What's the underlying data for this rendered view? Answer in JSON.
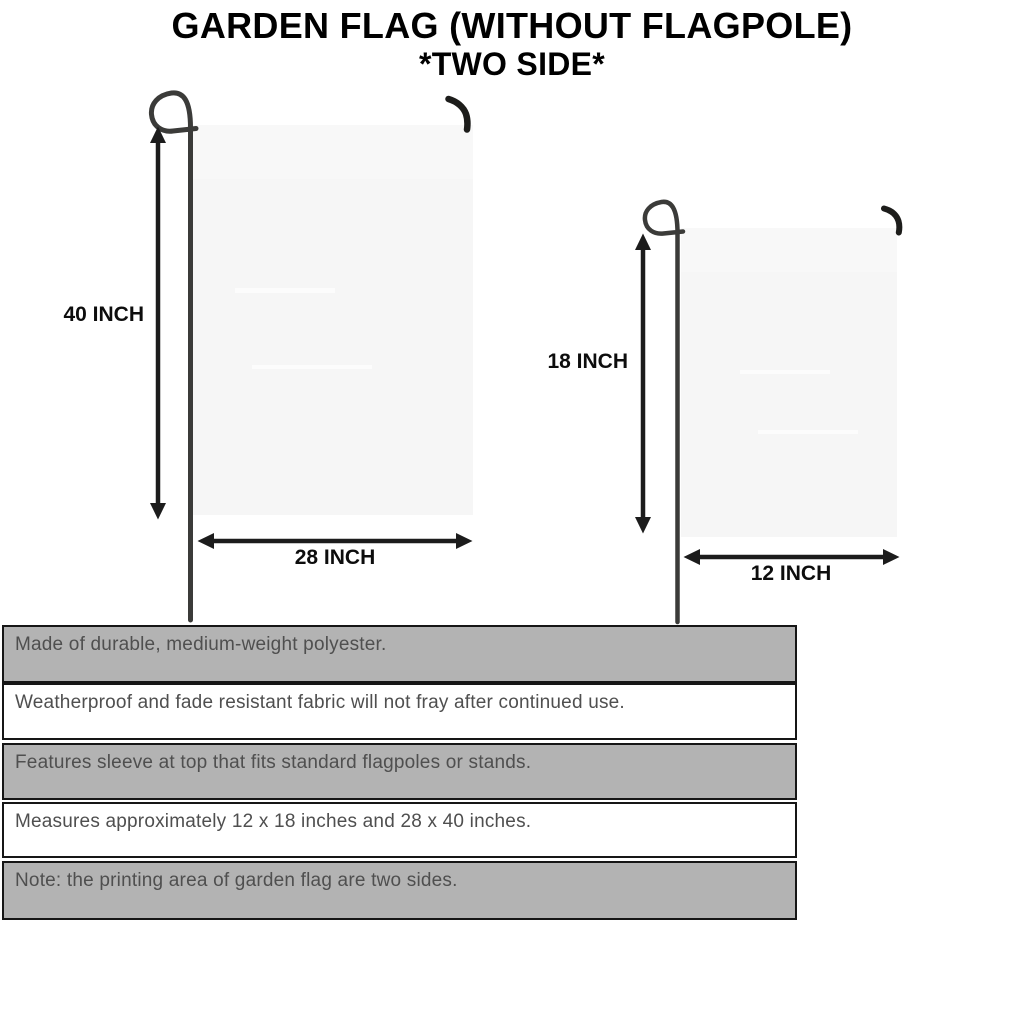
{
  "title": {
    "line1": "GARDEN FLAG (WITHOUT FLAGPOLE)",
    "line2": "*TWO SIDE*"
  },
  "diagrams": {
    "large_flag": {
      "height_label": "40 INCH",
      "width_label": "28 INCH"
    },
    "small_flag": {
      "height_label": "18 INCH",
      "width_label": "12 INCH"
    }
  },
  "features": [
    "Made of durable, medium-weight polyester.",
    "Weatherproof and fade resistant fabric will not fray after continued use.",
    "Features sleeve at top that fits standard flagpoles or stands.",
    "Measures approximately 12 x 18 inches and 28 x 40 inches.",
    "Note: the printing area of garden flag are two sides."
  ],
  "colors": {
    "title_text": "#000000",
    "flag_fill": "#f6f6f6",
    "pole": "#3b3b39",
    "hook": "#1d1d1b",
    "arrow": "#1c1c1c",
    "row_shaded": "#b3b3b3",
    "row_plain": "#ffffff",
    "table_border": "#161616",
    "feature_text": "#4f4f4f"
  }
}
